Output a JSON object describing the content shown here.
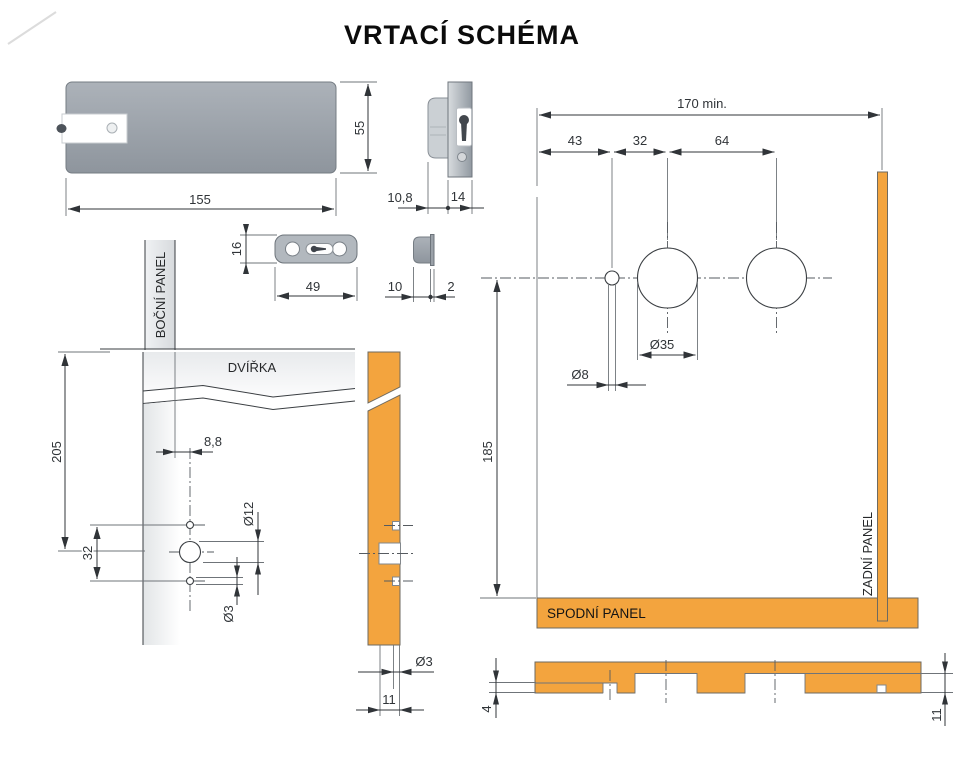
{
  "title": "VRTACÍ SCHÉMA",
  "colors": {
    "accent_orange": "#F3A43E",
    "body_gray": "#9BA2AA",
    "line": "#3A3E42"
  },
  "lock_top_view": {
    "width": "155",
    "height": "55"
  },
  "lock_side_view": {
    "body_depth": "10,8",
    "faceplate_width": "14"
  },
  "strike_plate_top": {
    "height": "16",
    "width": "49"
  },
  "strike_plate_side": {
    "depth": "10",
    "flange": "2"
  },
  "door_front_view": {
    "side_panel": "BOČNÍ PANEL",
    "door": "DVÍŘKA",
    "height_to_center": "205",
    "edge_offset": "8,8",
    "screw_spacing": "32",
    "center_hole": "Ø12",
    "screw_hole": "Ø3"
  },
  "door_edge_view": {
    "hole": "Ø3",
    "offset": "11"
  },
  "drill_plan": {
    "min_width": "170 min.",
    "dist_edge": "43",
    "dist_hole": "32",
    "dist_circles": "64",
    "circle_dia": "Ø35",
    "hole_dia": "Ø8",
    "height": "185",
    "bottom_panel": "SPODNÍ PANEL",
    "rear_panel": "ZADNÍ PANEL"
  },
  "bottom_panel_view": {
    "groove_depth": "4",
    "edge_offset": "11"
  }
}
